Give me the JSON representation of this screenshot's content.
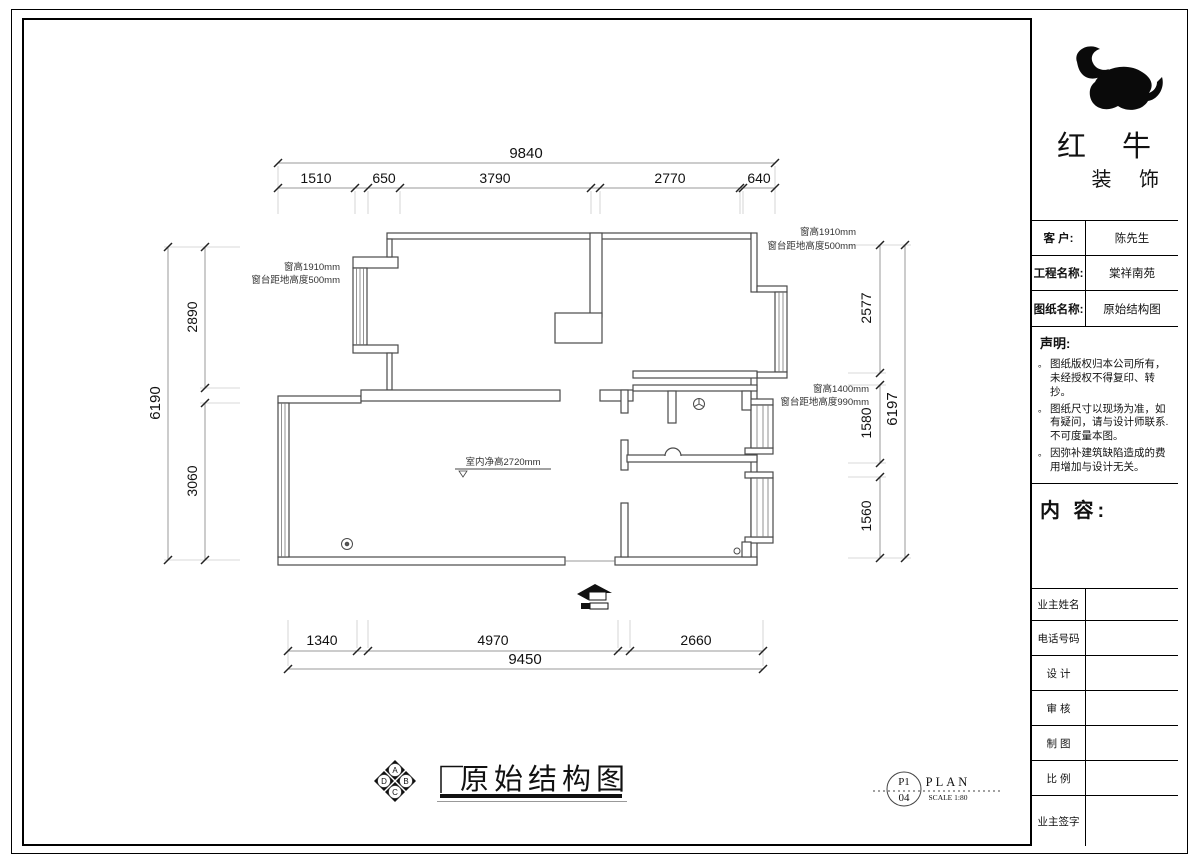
{
  "company": {
    "name_top": "红 牛",
    "name_bottom": "装 饰"
  },
  "title_block": {
    "fields": [
      {
        "label": "客 户:",
        "value": "陈先生"
      },
      {
        "label": "工程名称:",
        "value": "棠祥南苑"
      },
      {
        "label": "图纸名称:",
        "value": "原始结构图"
      }
    ],
    "statement": {
      "title": "声明:",
      "items": [
        "图纸版权归本公司所有，未经授权不得复印、转抄。",
        "图纸尺寸以现场为准，如有疑问，请与设计师联系.不可度量本图。",
        "因弥补建筑缺陷造成的费用增加与设计无关。"
      ]
    },
    "content_label": "内 容:",
    "sign_rows": [
      "业主姓名",
      "电话号码",
      "设 计",
      "审 核",
      "制 图",
      "比 例",
      "业主签字"
    ]
  },
  "plan": {
    "title": "原始结构图",
    "stamp": {
      "sheet": "P1",
      "number": "04",
      "type": "PLAN",
      "scale": "SCALE 1:80"
    },
    "compass_letters": [
      "A",
      "B",
      "C",
      "D"
    ],
    "annotations": {
      "window_left_line1": "窗高1910mm",
      "window_left_line2": "窗台距地高度500mm",
      "window_top_right_line1": "窗高1910mm",
      "window_top_right_line2": "窗台距地高度500mm",
      "window_right_line1": "窗高1400mm",
      "window_right_line2": "窗台距地高度990mm",
      "ceiling_height": "室内净高2720mm"
    },
    "dimensions": {
      "top_total": "9840",
      "top_segments": [
        "1510",
        "650",
        "3790",
        "2770",
        "640"
      ],
      "left_total": "6190",
      "left_segments": [
        "2890",
        "3060"
      ],
      "right_segments": [
        "2577",
        "1580",
        "1560"
      ],
      "right_total": "6197",
      "bottom_segments": [
        "1340",
        "4970",
        "2660"
      ],
      "bottom_total": "9450"
    }
  }
}
